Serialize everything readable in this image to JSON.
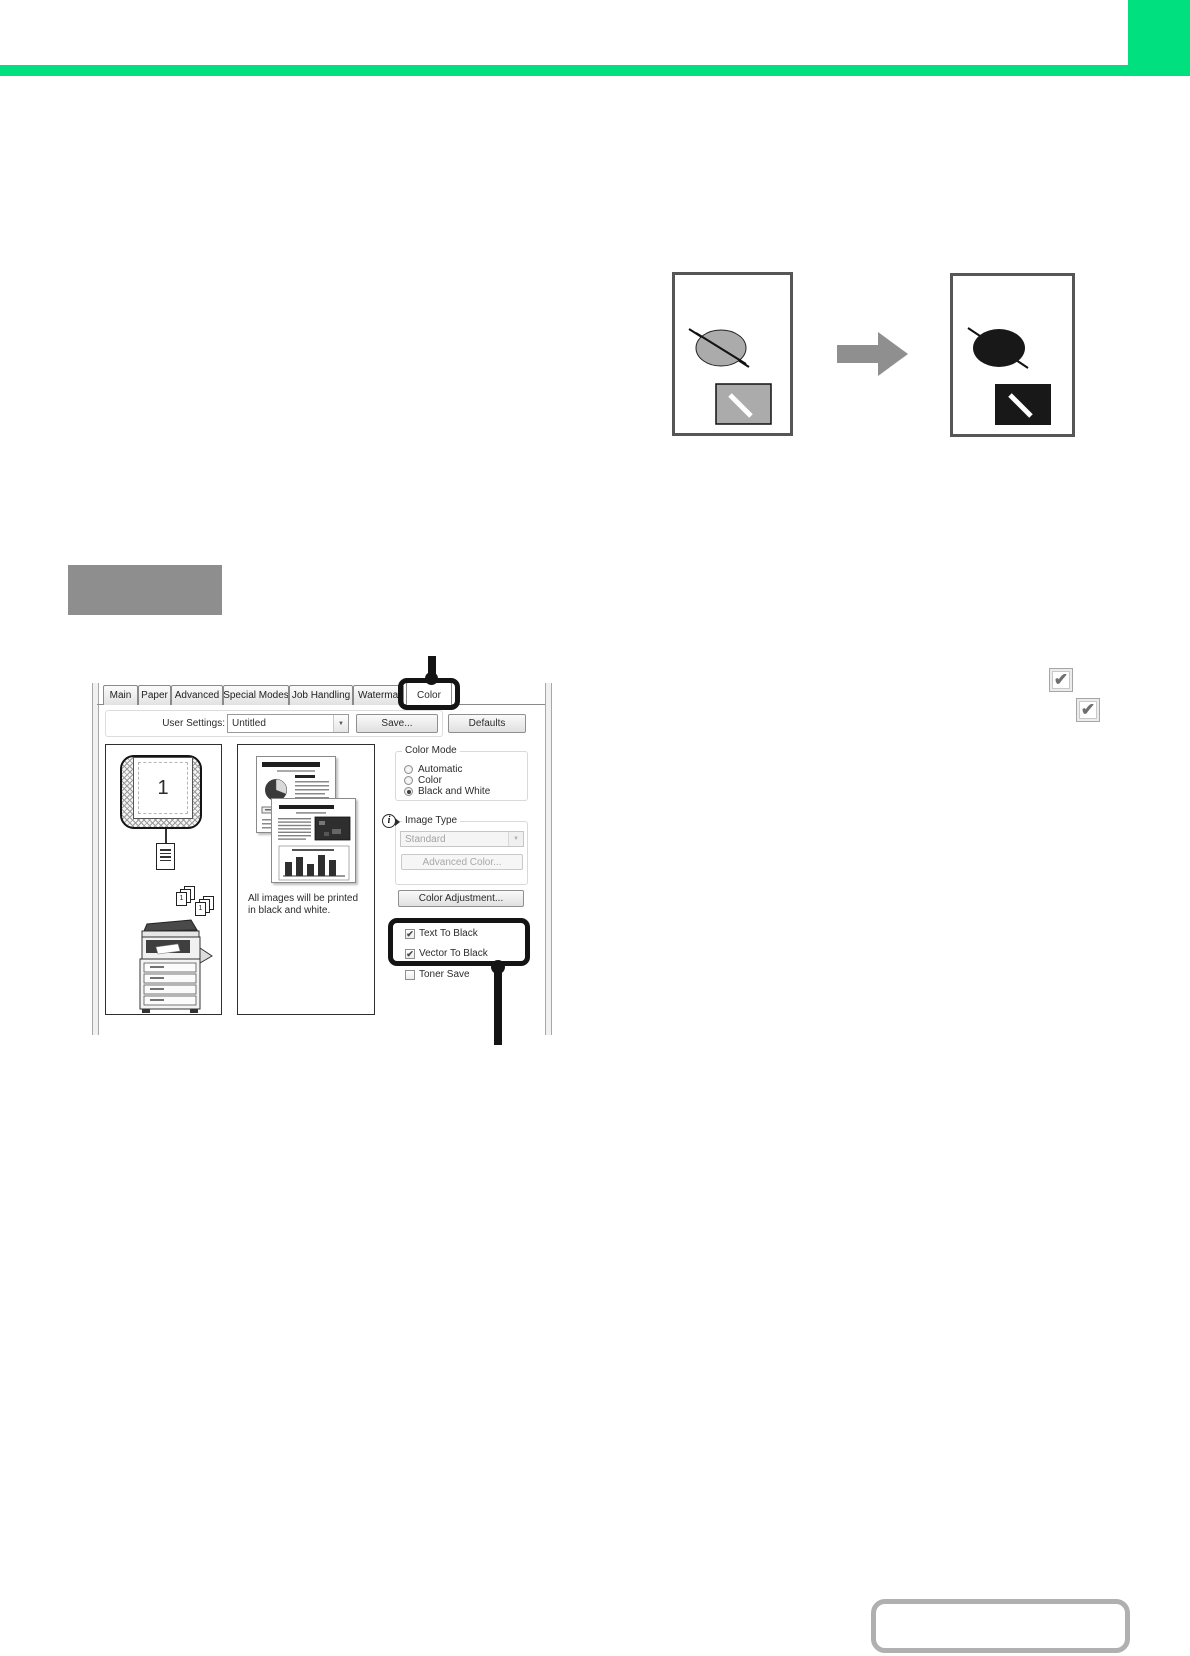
{
  "colors": {
    "accent_green": "#00E07E",
    "label_box_gray": "#8E8E8E",
    "figure_gray": "#ABABAB",
    "figure_black": "#181818"
  },
  "icons": {
    "check": "✔",
    "dropdown_arrow": "▼",
    "info": "i"
  },
  "dialog": {
    "tabs": [
      {
        "label": "Main"
      },
      {
        "label": "Paper"
      },
      {
        "label": "Advanced"
      },
      {
        "label": "Special Modes"
      },
      {
        "label": "Job Handling"
      },
      {
        "label": "Watermarks"
      },
      {
        "label": "Color",
        "active": true
      }
    ],
    "user_settings": {
      "label": "User Settings:",
      "value": "Untitled",
      "save_button": "Save...",
      "defaults_button": "Defaults"
    },
    "preview": {
      "page_number": "1",
      "collate_digits": [
        "1",
        "2",
        "3"
      ],
      "message": "All images will be printed in black and white."
    },
    "color_mode": {
      "title": "Color Mode",
      "options": [
        {
          "label": "Automatic",
          "selected": false
        },
        {
          "label": "Color",
          "selected": false
        },
        {
          "label": "Black and White",
          "selected": true
        }
      ]
    },
    "image_type": {
      "title": "Image Type",
      "value": "Standard",
      "advanced_color_button": "Advanced Color..."
    },
    "color_adjustment_button": "Color Adjustment...",
    "checkbox_options": [
      {
        "label": "Text To Black",
        "checked": true
      },
      {
        "label": "Vector To Black",
        "checked": true
      },
      {
        "label": "Toner Save",
        "checked": false
      }
    ]
  }
}
